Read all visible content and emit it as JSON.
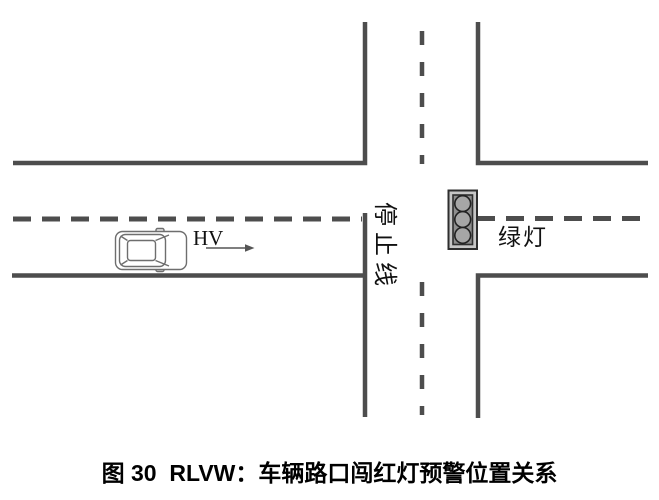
{
  "figure": {
    "caption": "图 30  RLVW：车辆路口闯红灯预警位置关系",
    "labels": {
      "host_vehicle": "HV",
      "stop_line": "停止线",
      "signal_state": "绿灯"
    },
    "icons": {
      "traffic_light": "traffic-light-icon",
      "car": "car-top-view-icon",
      "direction_arrow": "right-arrow-icon"
    },
    "colors": {
      "road_line": "#4d4d4d",
      "car_outline": "#6e6e6e",
      "signal_housing": "#c6c6c6",
      "signal_panel": "#8e8e8e",
      "signal_lamp": "#a6a6a6",
      "signal_border": "#2e2e2e",
      "text": "#111111",
      "background": "#ffffff"
    }
  }
}
